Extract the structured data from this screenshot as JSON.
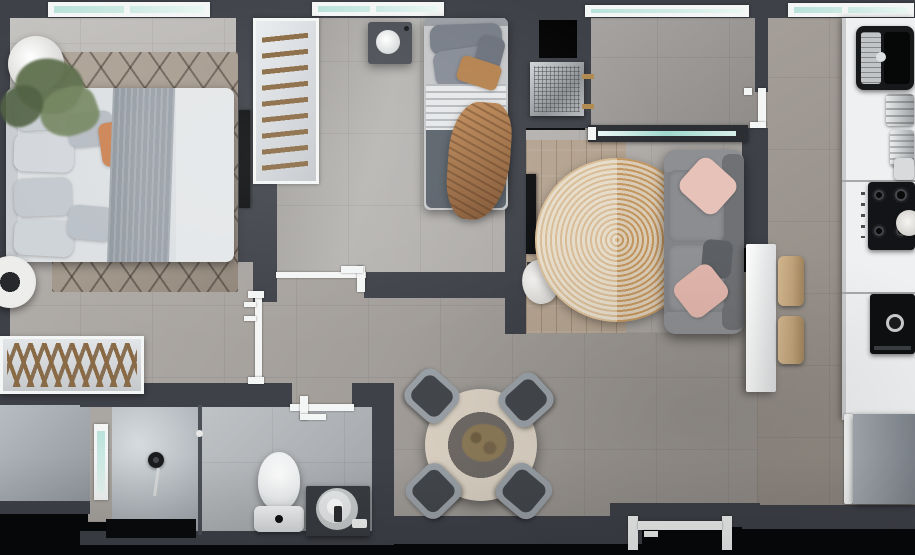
{
  "scene": {
    "kind": "3d-apartment-floor-plan-top-down-render"
  },
  "palette": {
    "black": "#07080a",
    "wall": "#3e4148",
    "walldark": "#2f3237",
    "frame": "#f4f5f5",
    "glass": "#cdeae3",
    "linen": "#dde0e3",
    "pillow": "#c9ced4",
    "orange": "#cb8454",
    "throw": "#9aa1a9",
    "rugbase": "#a2978b",
    "jute1": "#c2955e",
    "jute2": "#dacbb5",
    "sofa": "#828487",
    "pink": "#e7c2b9",
    "wood": "#b3a28f",
    "counter": "#eef0f1",
    "steel": "#c6c9cc",
    "appl": "#131417",
    "stool": "#c0a37a",
    "tablewood": "#d9d0c2",
    "tablecenter": "#6e6965",
    "chair": "#99a0a6",
    "chairseat": "#43474b",
    "toilet": "#eff1f2",
    "vanity": "#393c41",
    "mat": "#0a0b0c",
    "plant": "#5c6e4b",
    "blanket": "#b5824f"
  },
  "rooms": [
    {
      "name": "master-bedroom",
      "furniture": [
        "double-bed",
        "gray-throw",
        "orange-accent-pillow",
        "diamond-pattern-rug",
        "potted-plant",
        "wall-mounted-tv",
        "round-pouf",
        "window"
      ]
    },
    {
      "name": "wardrobe-nook",
      "furniture": [
        "ladder-clothes-rack"
      ]
    },
    {
      "name": "second-bedroom",
      "furniture": [
        "single-bed",
        "tan-blanket",
        "nightstand",
        "round-table-lamp",
        "window"
      ]
    },
    {
      "name": "entry-hall",
      "furniture": [
        "dark-wall-panel",
        "metal-mesh-cabinet"
      ]
    },
    {
      "name": "corridor",
      "furniture": [
        "window",
        "glass-partition",
        "kitchen-doorway"
      ]
    },
    {
      "name": "living-room",
      "furniture": [
        "two-seat-sofa",
        "pink-cushions",
        "round-jute-rug",
        "wall-mounted-tv",
        "wood-flooring",
        "sheepskin-rug"
      ]
    },
    {
      "name": "kitchen",
      "furniture": [
        "white-counter",
        "sink",
        "dish-rack",
        "cookware",
        "gas-cooktop",
        "plate",
        "oven",
        "refrigerator",
        "breakfast-bar",
        "bar-stools",
        "window"
      ]
    },
    {
      "name": "dining-area",
      "furniture": [
        "round-dining-table",
        "dining-chairs",
        "centerpiece-plant",
        "entry-door"
      ]
    },
    {
      "name": "hallway",
      "furniture": [
        "slatted-console-table",
        "bedroom-doorway"
      ]
    },
    {
      "name": "bathroom",
      "furniture": [
        "walk-in-shower",
        "glass-screen",
        "shower-set",
        "toilet",
        "round-basin-vanity",
        "black-mat",
        "window",
        "doorway"
      ]
    },
    {
      "name": "utility-room",
      "furniture": []
    }
  ],
  "counts": {
    "bedrooms": 2,
    "windows": 6,
    "dining_chairs": 4,
    "bar_stools": 2,
    "sofa_pink_cushions": 2
  }
}
